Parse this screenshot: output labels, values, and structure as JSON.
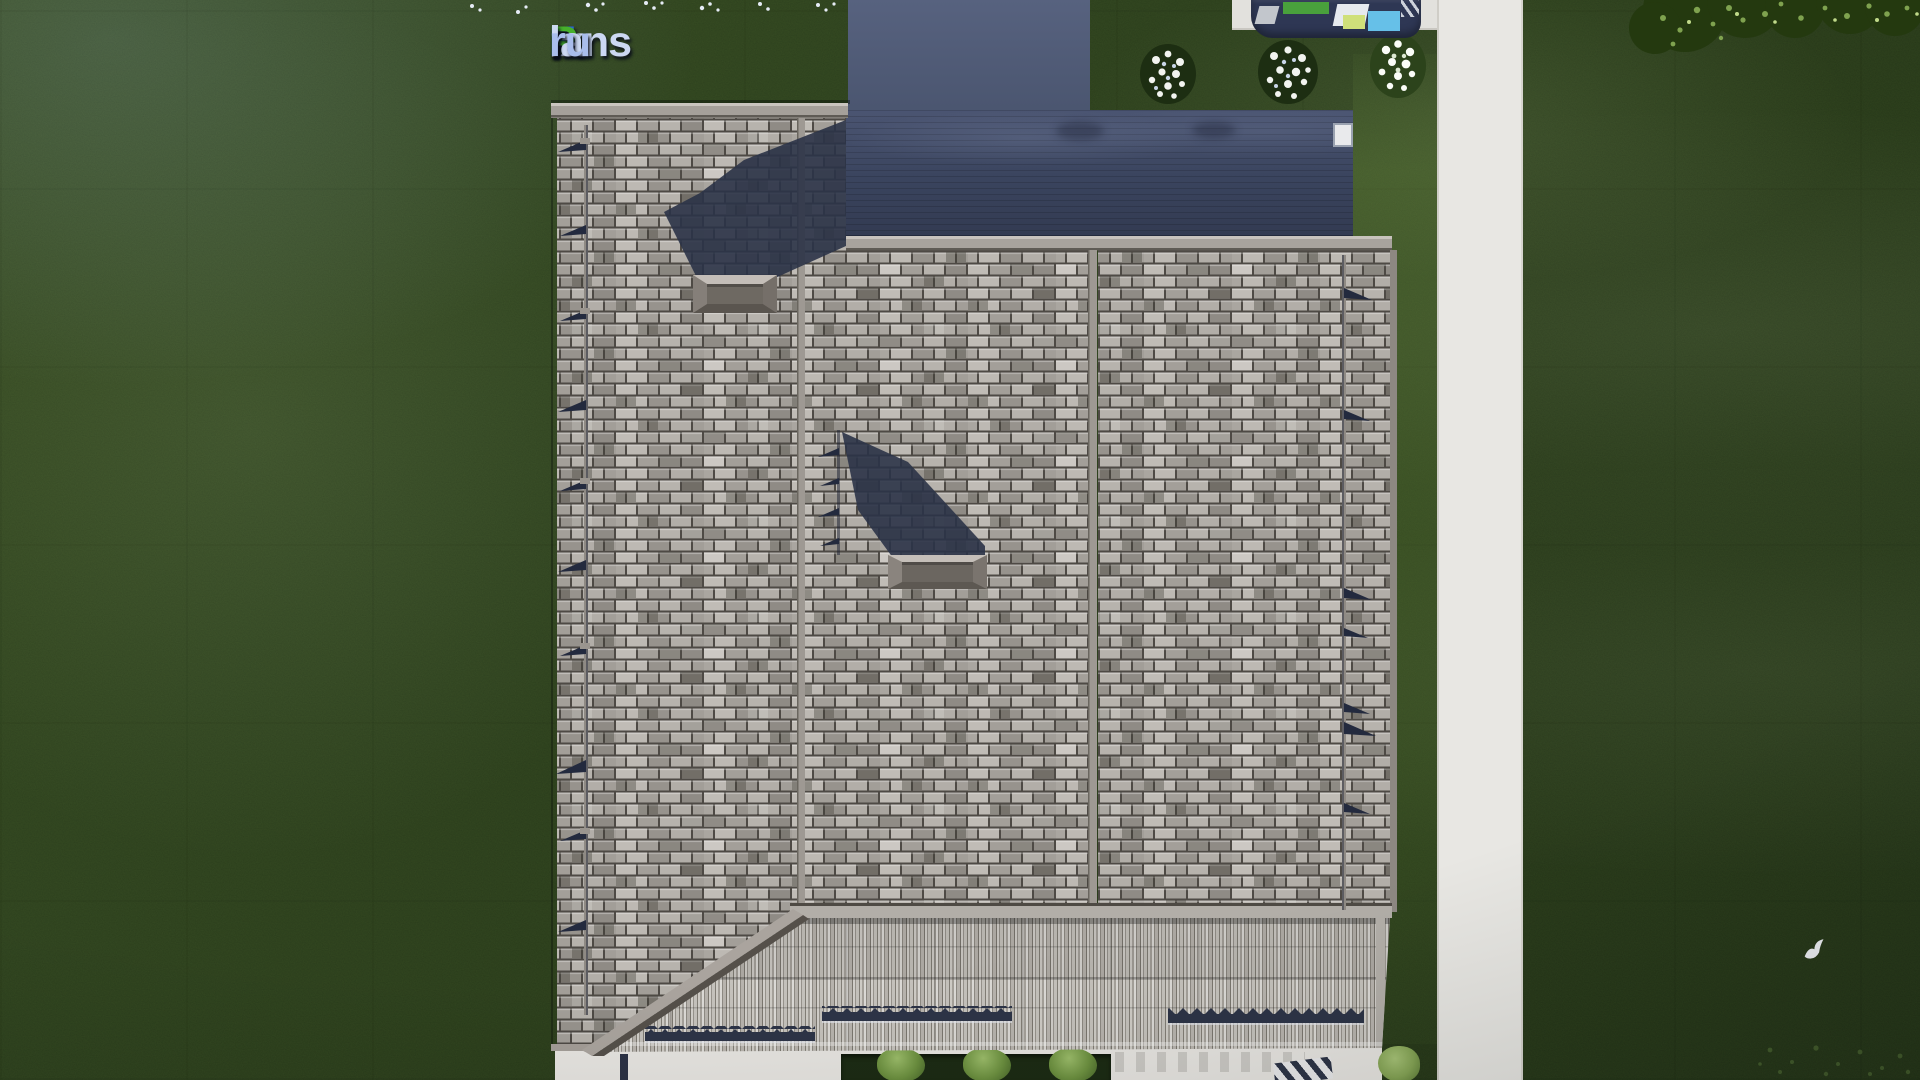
{
  "watermark": {
    "full_text": "FixPlans.ru",
    "parts": [
      {
        "text": "F",
        "color": "#2a66e2"
      },
      {
        "text": "ix",
        "color": "#ccd8f2"
      },
      {
        "text": "P",
        "color": "#46b02c"
      },
      {
        "text": "lans",
        "color": "#ccd8f2"
      },
      {
        "text": ".",
        "color": "#2a52d4"
      },
      {
        "text": "ru",
        "color": "#a9bdec"
      }
    ]
  },
  "colors": {
    "grass": "#2b3e1d",
    "grass-dark": "#223117",
    "path": "#e8e7e3",
    "pavement": "#e7e5e1",
    "roof-tile-light": "#c0bcb6",
    "roof-tile-mid": "#a39f99",
    "roof-tile-dark": "#8f8b85",
    "roof-gap": "#4e4a45",
    "ridge-trim": "#a8a39d",
    "deck-top": "#4b5572",
    "deck-bottom": "#333b52",
    "driveway": "#515c7a",
    "shadow-navy": "#2b3347",
    "stripe-light": "#d8d6d2",
    "stripe-dark": "#8e8a83",
    "snow-guard": "#2d3447",
    "hedge": "#1c2b14",
    "bush-green": "#6d9140",
    "flower-white": "#f2f4f0",
    "car-body": "#2e3754",
    "car-green": "#49a13c",
    "car-cyan": "#66c0e8",
    "car-lime": "#cfe07a"
  }
}
